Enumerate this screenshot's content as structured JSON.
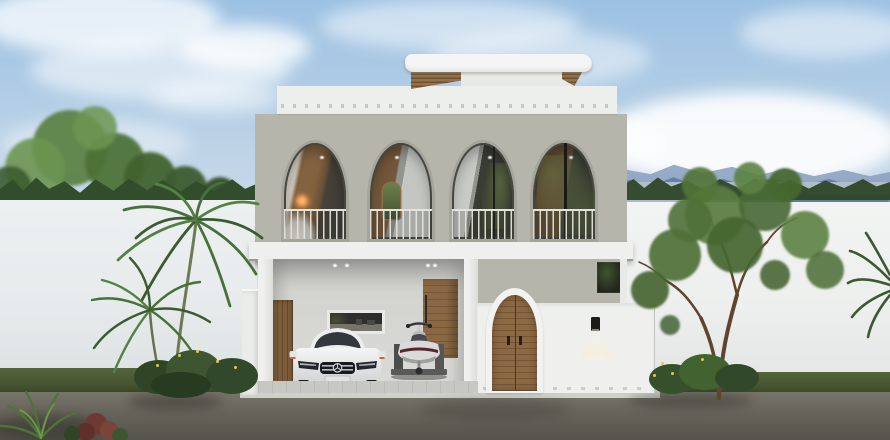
{
  "scene": {
    "setting": "front elevation render of a two-storey modern villa at dusk",
    "upper_floor": {
      "arched_openings": 4,
      "balcony_railings": true,
      "interior": "warm wood with lamp glow"
    },
    "roof": {
      "type": "rounded white floating canopy",
      "fascia": "wood slats"
    },
    "ground_floor": {
      "carport_vehicles": [
        "white sedan car",
        "jet ski on trailer"
      ],
      "doors": [
        "wooden entry door",
        "arched double wooden gate"
      ],
      "kitchen_window": true,
      "wall_lamp_lit": true
    },
    "surroundings": {
      "left": "palm tree, flowering shrubs, white perimeter wall with green trees behind",
      "right": "young tree, white perimeter wall, lake and blue mountain ridges behind",
      "foreground": "asphalt road with grass verge and corner plants",
      "sky": "blue with soft white clouds"
    }
  },
  "colors": {
    "sky_top": "#9cc1e3",
    "sky_mid": "#c2d6e7",
    "sky_horizon": "#dfe8ee",
    "mountain_far": "#8aa0bf",
    "mountain_near": "#5e7dab",
    "water": "#a7bac3",
    "water_deep": "#4f7a88",
    "treeline": "#2e4628",
    "wall_left": "#e7ebec",
    "wall_right": "#edefee",
    "grass": "#46532f",
    "road_top": "#77746a",
    "road_bottom": "#55534b",
    "facade": "#b5b5ac",
    "parapet": "#edefed",
    "canopy_white": "#f4f5f4",
    "wood_dark": "#6e5234",
    "slab": "#eff0ee",
    "arch_frame": "#a5a59c",
    "interior_wood": "#82613f",
    "curtain": "#c4c6c2",
    "apron": "#ced0ca",
    "floor_tile": "#c7c8c3",
    "gate_wood": "#8c6843",
    "lamp_black": "#1c1c1a",
    "flower_yellow": "#e2c84d",
    "car_white": "#eceded"
  }
}
